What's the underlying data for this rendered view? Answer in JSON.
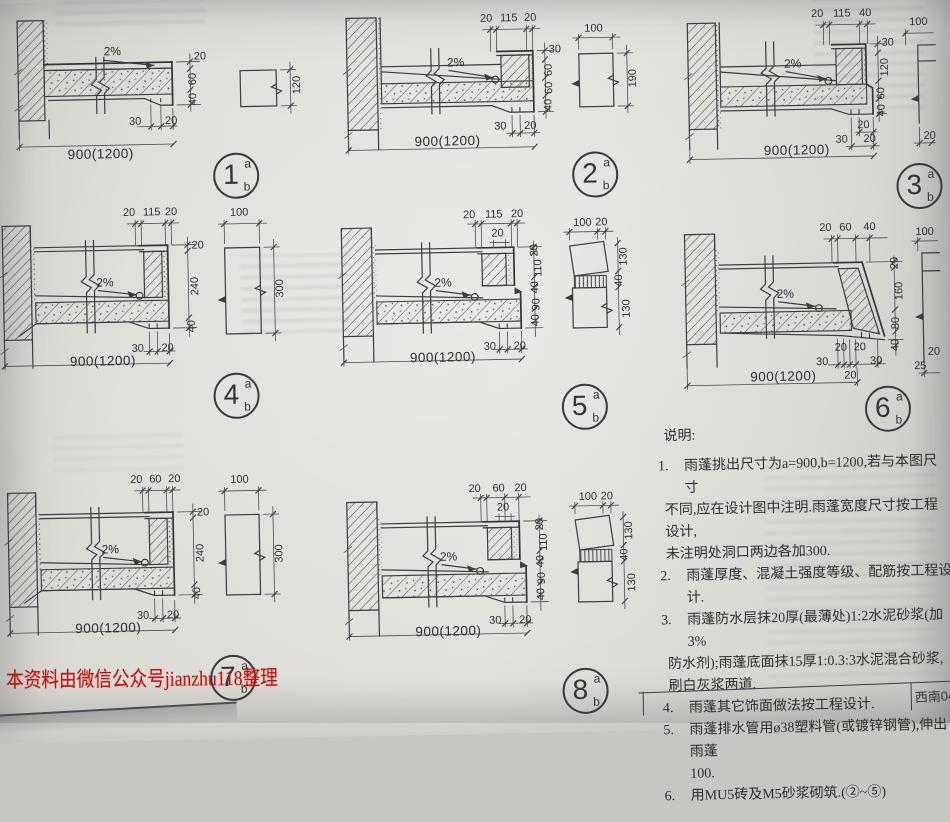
{
  "page": {
    "watermark": "本资料由微信公众号jianzhu118整理",
    "title_block_code": "西南04J5"
  },
  "notes": {
    "title": "说明:",
    "items": [
      {
        "no": "1.",
        "lines": [
          "雨蓬挑出尺寸为a=900,b=1200,若与本图尺寸",
          "不同,应在设计图中注明.雨蓬宽度尺寸按工程设计,",
          "未注明处洞口两边各加300."
        ]
      },
      {
        "no": "2.",
        "lines": [
          "雨蓬厚度、混凝土强度等级、配筋按工程设计."
        ]
      },
      {
        "no": "3.",
        "lines": [
          "雨蓬防水层抹20厚(最薄处)1:2水泥砂浆(加3%",
          "防水剂);雨蓬底面抹15厚1:0.3:3水泥混合砂浆,",
          "刷白灰浆两道."
        ]
      },
      {
        "no": "4.",
        "lines": [
          "雨蓬其它饰面做法按工程设计."
        ]
      },
      {
        "no": "5.",
        "lines": [
          "雨蓬排水管用ø38塑料管(或镀锌钢管),伸出雨蓬",
          "100."
        ]
      },
      {
        "no": "6.",
        "lines": [
          "用MU5砖及M5砂浆砌筑.(②~⑤)"
        ]
      }
    ]
  },
  "details": {
    "d1": {
      "n": "1",
      "sup": "a",
      "sub": "b",
      "slope": "2%",
      "span": "900(1200)",
      "right": [
        "20",
        "60",
        "40"
      ],
      "bottom": [
        "30",
        "20"
      ],
      "side": {
        "right": "120"
      }
    },
    "d2": {
      "n": "2",
      "sup": "a",
      "sub": "b",
      "slope": "2%",
      "span": "900(1200)",
      "top": [
        "20",
        "115",
        "20"
      ],
      "right": [
        "30",
        "60",
        "60",
        "40"
      ],
      "bottom": [
        "30",
        "20"
      ],
      "side": {
        "top": "100",
        "right": "190"
      }
    },
    "d3": {
      "n": "3",
      "sup": "a",
      "sub": "b",
      "slope": "2%",
      "span": "900(1200)",
      "top": [
        "20",
        "115",
        "40"
      ],
      "right": [
        "30",
        "120",
        "60",
        "40"
      ],
      "bottom_upper": "20",
      "bottom": [
        "30",
        "20"
      ],
      "side": {
        "top": "100",
        "bottom": "20"
      }
    },
    "d4": {
      "n": "4",
      "sup": "a",
      "sub": "b",
      "slope": "2%",
      "span": "900(1200)",
      "top": [
        "20",
        "115",
        "20"
      ],
      "right": [
        "20",
        "240",
        "40"
      ],
      "bottom": [
        "30",
        "20"
      ],
      "side": {
        "top": "100",
        "right": "300"
      }
    },
    "d5": {
      "n": "5",
      "sup": "a",
      "sub": "b",
      "slope": "2%",
      "span": "900(1200)",
      "top": [
        "20",
        "115",
        "20"
      ],
      "top2": "20",
      "right": [
        "20",
        "110",
        "40",
        "90",
        "40"
      ],
      "bottom": [
        "30",
        "20"
      ],
      "side": {
        "top": "100",
        "top2": "20",
        "right": [
          "130",
          "40",
          "130"
        ]
      }
    },
    "d6": {
      "n": "6",
      "sup": "a",
      "sub": "b",
      "slope": "2%",
      "span": "900(1200)",
      "top": [
        "20",
        "60",
        "40"
      ],
      "right": [
        "20",
        "160",
        "80",
        "40"
      ],
      "bottom_upper": [
        "20",
        "20"
      ],
      "bottom": [
        "30",
        "30"
      ],
      "bottom_sub": "20",
      "side": {
        "top": "100",
        "bottom": [
          "20",
          "25"
        ]
      }
    },
    "d7": {
      "n": "7",
      "sup": "a",
      "sub": "b",
      "slope": "2%",
      "span": "900(1200)",
      "top": [
        "20",
        "60",
        "20"
      ],
      "right": [
        "20",
        "240",
        "40"
      ],
      "bottom": [
        "30",
        "20"
      ],
      "side": {
        "top": "100",
        "right": "300"
      }
    },
    "d8": {
      "n": "8",
      "sup": "a",
      "sub": "b",
      "slope": "2%",
      "span": "900(1200)",
      "top": [
        "20",
        "60",
        "20"
      ],
      "top2": "20",
      "right": [
        "20",
        "110",
        "40",
        "90",
        "40"
      ],
      "bottom": [
        "30",
        "20"
      ],
      "side": {
        "top": "100",
        "top2": "20",
        "right": [
          "130",
          "40",
          "130"
        ]
      }
    }
  }
}
